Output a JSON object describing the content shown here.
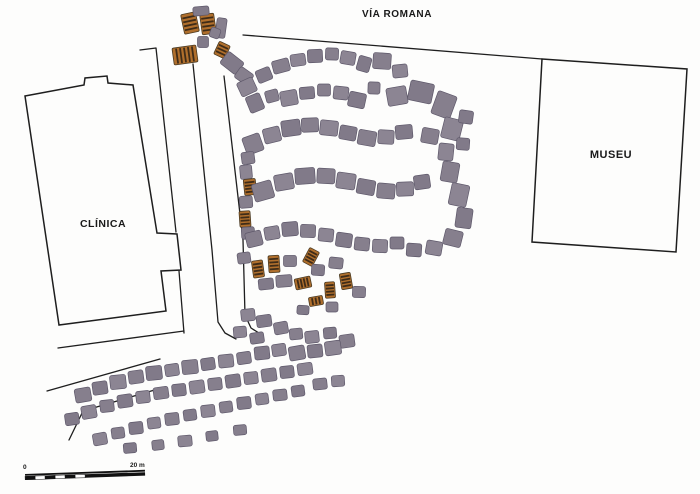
{
  "labels": {
    "via_romana": "VÍA ROMANA",
    "clinica": "CLÍNICA",
    "museu": "MUSEU",
    "scale_zero": "0",
    "scale_end": "20 m"
  },
  "colors": {
    "line": "#1e1e1e",
    "building_fill": "#fdfdfc",
    "ruin_fills": [
      "#867f8d",
      "#8c8593",
      "#817a89"
    ],
    "ruin_stroke": "#5e586a",
    "excavation_fill": "#b06f2c",
    "excavation_stripe": "#3f2c18",
    "excavation_stroke": "#4a3a22"
  },
  "site_plan": {
    "canvas": {
      "width": 700,
      "height": 494
    },
    "buildings": [
      {
        "name": "clinica-building-outline",
        "points": [
          [
            25,
            96
          ],
          [
            84,
            85
          ],
          [
            85,
            78
          ],
          [
            107,
            76
          ],
          [
            108,
            83
          ],
          [
            133,
            85
          ],
          [
            157,
            233
          ],
          [
            177,
            234
          ],
          [
            181,
            270
          ],
          [
            161,
            271
          ],
          [
            166,
            311
          ],
          [
            59,
            325
          ]
        ]
      },
      {
        "name": "museu-building-outline",
        "points": [
          [
            542,
            59
          ],
          [
            687,
            69
          ],
          [
            676,
            252
          ],
          [
            532,
            242
          ]
        ]
      }
    ],
    "lines": [
      {
        "name": "via-romana-road-line",
        "points": [
          [
            243,
            35
          ],
          [
            542,
            59
          ]
        ]
      },
      {
        "name": "clinica-fence-north",
        "points": [
          [
            140,
            50
          ],
          [
            156,
            48
          ],
          [
            176,
            232
          ]
        ]
      },
      {
        "name": "clinica-fence-south",
        "points": [
          [
            179,
            271
          ],
          [
            184,
            333
          ]
        ]
      },
      {
        "name": "road-south-of-clinica",
        "points": [
          [
            58,
            348
          ],
          [
            184,
            331
          ]
        ]
      },
      {
        "name": "boundary-line-mid",
        "points": [
          [
            47,
            391
          ],
          [
            160,
            359
          ]
        ]
      },
      {
        "name": "boundary-line-low",
        "points": [
          [
            69,
            440
          ],
          [
            83,
            411
          ],
          [
            158,
            389
          ]
        ]
      },
      {
        "name": "street-west-edge",
        "points": [
          [
            193,
            64
          ],
          [
            212,
            250
          ],
          [
            218,
            322
          ],
          [
            225,
            333
          ],
          [
            236,
            339
          ]
        ]
      },
      {
        "name": "street-east-edge",
        "points": [
          [
            224,
            76
          ],
          [
            243,
            240
          ],
          [
            245,
            315
          ],
          [
            251,
            328
          ],
          [
            262,
            335
          ]
        ]
      }
    ],
    "blocks_format": "[cx,cy,w,h,rot_deg,type] type 0=stone-ruin 1=striped-excavation",
    "blocks": [
      [
        190,
        23,
        15,
        20,
        -12,
        1
      ],
      [
        208,
        24,
        14,
        20,
        -8,
        1
      ],
      [
        201,
        11,
        16,
        9,
        -5,
        0
      ],
      [
        221,
        28,
        10,
        20,
        8,
        0
      ],
      [
        185,
        55,
        24,
        17,
        -8,
        1
      ],
      [
        203,
        42,
        11,
        11,
        0,
        0
      ],
      [
        215,
        33,
        10,
        10,
        20,
        0
      ],
      [
        222,
        50,
        12,
        14,
        25,
        1
      ],
      [
        232,
        63,
        20,
        15,
        38,
        0
      ],
      [
        244,
        76,
        16,
        13,
        35,
        0
      ],
      [
        247,
        87,
        17,
        15,
        -25,
        0
      ],
      [
        264,
        75,
        15,
        13,
        -22,
        0
      ],
      [
        281,
        66,
        17,
        13,
        -15,
        0
      ],
      [
        298,
        60,
        15,
        12,
        -8,
        0
      ],
      [
        315,
        56,
        15,
        13,
        -3,
        0
      ],
      [
        332,
        54,
        13,
        12,
        2,
        0
      ],
      [
        348,
        58,
        15,
        13,
        10,
        0
      ],
      [
        364,
        64,
        13,
        15,
        16,
        0
      ],
      [
        382,
        61,
        18,
        16,
        4,
        0
      ],
      [
        400,
        71,
        15,
        13,
        -6,
        0
      ],
      [
        255,
        103,
        15,
        17,
        -22,
        0
      ],
      [
        272,
        96,
        13,
        12,
        -15,
        0
      ],
      [
        289,
        98,
        17,
        15,
        -10,
        0
      ],
      [
        307,
        93,
        15,
        12,
        -5,
        0
      ],
      [
        324,
        90,
        13,
        12,
        0,
        0
      ],
      [
        341,
        93,
        15,
        13,
        6,
        0
      ],
      [
        357,
        100,
        17,
        15,
        12,
        0
      ],
      [
        374,
        88,
        12,
        12,
        2,
        0
      ],
      [
        397,
        96,
        20,
        18,
        -10,
        0
      ],
      [
        421,
        92,
        24,
        20,
        12,
        0
      ],
      [
        444,
        105,
        20,
        24,
        20,
        0
      ],
      [
        452,
        129,
        19,
        21,
        14,
        0
      ],
      [
        466,
        117,
        14,
        13,
        8,
        0
      ],
      [
        430,
        136,
        17,
        15,
        10,
        0
      ],
      [
        446,
        152,
        15,
        17,
        6,
        0
      ],
      [
        463,
        144,
        13,
        12,
        4,
        0
      ],
      [
        253,
        144,
        18,
        18,
        -20,
        0
      ],
      [
        272,
        135,
        17,
        15,
        -14,
        0
      ],
      [
        291,
        128,
        19,
        16,
        -8,
        0
      ],
      [
        310,
        125,
        17,
        14,
        -2,
        0
      ],
      [
        329,
        128,
        18,
        15,
        6,
        0
      ],
      [
        348,
        133,
        17,
        14,
        10,
        0
      ],
      [
        367,
        138,
        18,
        15,
        10,
        0
      ],
      [
        386,
        137,
        16,
        14,
        3,
        0
      ],
      [
        404,
        132,
        17,
        14,
        -5,
        0
      ],
      [
        248,
        158,
        13,
        12,
        -8,
        0
      ],
      [
        246,
        172,
        12,
        14,
        -5,
        0
      ],
      [
        250,
        187,
        12,
        16,
        -6,
        1
      ],
      [
        246,
        202,
        13,
        12,
        -4,
        0
      ],
      [
        245,
        219,
        11,
        16,
        -4,
        1
      ],
      [
        248,
        233,
        13,
        12,
        -3,
        0
      ],
      [
        263,
        191,
        20,
        18,
        -16,
        0
      ],
      [
        284,
        182,
        19,
        16,
        -10,
        0
      ],
      [
        305,
        176,
        20,
        16,
        -4,
        0
      ],
      [
        326,
        176,
        18,
        15,
        3,
        0
      ],
      [
        346,
        181,
        19,
        16,
        8,
        0
      ],
      [
        366,
        187,
        18,
        15,
        10,
        0
      ],
      [
        386,
        191,
        18,
        15,
        5,
        0
      ],
      [
        405,
        189,
        17,
        14,
        -2,
        0
      ],
      [
        422,
        182,
        16,
        14,
        -8,
        0
      ],
      [
        450,
        172,
        17,
        20,
        10,
        0
      ],
      [
        459,
        195,
        18,
        22,
        12,
        0
      ],
      [
        464,
        218,
        16,
        20,
        8,
        0
      ],
      [
        453,
        238,
        18,
        16,
        14,
        0
      ],
      [
        434,
        248,
        16,
        14,
        10,
        0
      ],
      [
        414,
        250,
        15,
        13,
        4,
        0
      ],
      [
        254,
        239,
        16,
        15,
        -14,
        0
      ],
      [
        272,
        233,
        15,
        13,
        -10,
        0
      ],
      [
        290,
        229,
        16,
        14,
        -5,
        0
      ],
      [
        308,
        231,
        15,
        13,
        2,
        0
      ],
      [
        326,
        235,
        15,
        13,
        6,
        0
      ],
      [
        344,
        240,
        16,
        14,
        8,
        0
      ],
      [
        362,
        244,
        15,
        13,
        6,
        0
      ],
      [
        380,
        246,
        15,
        13,
        3,
        0
      ],
      [
        397,
        243,
        14,
        12,
        0,
        0
      ],
      [
        244,
        258,
        13,
        11,
        -8,
        0
      ],
      [
        258,
        269,
        11,
        17,
        -8,
        1
      ],
      [
        274,
        264,
        11,
        17,
        -4,
        1
      ],
      [
        290,
        261,
        13,
        11,
        0,
        0
      ],
      [
        311,
        257,
        11,
        16,
        28,
        1
      ],
      [
        266,
        284,
        15,
        11,
        -6,
        0
      ],
      [
        284,
        281,
        16,
        12,
        -4,
        0
      ],
      [
        303,
        283,
        11,
        16,
        78,
        1
      ],
      [
        318,
        270,
        13,
        11,
        4,
        0
      ],
      [
        336,
        263,
        14,
        11,
        6,
        0
      ],
      [
        330,
        290,
        10,
        16,
        -4,
        1
      ],
      [
        346,
        281,
        11,
        16,
        -10,
        1
      ],
      [
        359,
        292,
        13,
        11,
        2,
        0
      ],
      [
        316,
        301,
        9,
        14,
        80,
        1
      ],
      [
        303,
        310,
        12,
        9,
        4,
        0
      ],
      [
        332,
        307,
        12,
        10,
        0,
        0
      ],
      [
        248,
        315,
        14,
        12,
        -6,
        0
      ],
      [
        264,
        321,
        15,
        12,
        -8,
        0
      ],
      [
        281,
        328,
        14,
        12,
        -10,
        0
      ],
      [
        240,
        332,
        13,
        11,
        -5,
        0
      ],
      [
        257,
        338,
        14,
        11,
        -8,
        0
      ],
      [
        296,
        334,
        13,
        11,
        -6,
        0
      ],
      [
        312,
        337,
        14,
        12,
        -6,
        0
      ],
      [
        330,
        333,
        13,
        11,
        -5,
        0
      ],
      [
        347,
        341,
        15,
        13,
        -8,
        0
      ],
      [
        333,
        348,
        16,
        14,
        -8,
        0
      ],
      [
        315,
        351,
        15,
        13,
        -6,
        0
      ],
      [
        297,
        353,
        16,
        14,
        -10,
        0
      ],
      [
        279,
        350,
        14,
        12,
        -8,
        0
      ],
      [
        262,
        353,
        15,
        13,
        -6,
        0
      ],
      [
        244,
        358,
        14,
        12,
        -8,
        0
      ],
      [
        226,
        361,
        15,
        13,
        -6,
        0
      ],
      [
        208,
        364,
        14,
        12,
        -8,
        0
      ],
      [
        190,
        367,
        16,
        14,
        -6,
        0
      ],
      [
        172,
        370,
        14,
        12,
        -8,
        0
      ],
      [
        154,
        373,
        16,
        14,
        -6,
        0
      ],
      [
        136,
        377,
        15,
        13,
        -8,
        0
      ],
      [
        118,
        382,
        16,
        14,
        -6,
        0
      ],
      [
        100,
        388,
        15,
        13,
        -8,
        0
      ],
      [
        83,
        395,
        16,
        14,
        -10,
        0
      ],
      [
        305,
        369,
        15,
        12,
        -8,
        0
      ],
      [
        287,
        372,
        14,
        12,
        -6,
        0
      ],
      [
        269,
        375,
        15,
        13,
        -8,
        0
      ],
      [
        251,
        378,
        14,
        12,
        -6,
        0
      ],
      [
        233,
        381,
        15,
        13,
        -8,
        0
      ],
      [
        215,
        384,
        14,
        12,
        -6,
        0
      ],
      [
        197,
        387,
        15,
        13,
        -8,
        0
      ],
      [
        179,
        390,
        14,
        12,
        -6,
        0
      ],
      [
        161,
        393,
        15,
        12,
        -8,
        0
      ],
      [
        143,
        397,
        14,
        12,
        -6,
        0
      ],
      [
        125,
        401,
        15,
        13,
        -8,
        0
      ],
      [
        107,
        406,
        14,
        12,
        -6,
        0
      ],
      [
        89,
        412,
        15,
        13,
        -10,
        0
      ],
      [
        72,
        419,
        14,
        12,
        -8,
        0
      ],
      [
        320,
        384,
        14,
        11,
        -6,
        0
      ],
      [
        338,
        381,
        13,
        11,
        -4,
        0
      ],
      [
        298,
        391,
        13,
        11,
        -8,
        0
      ],
      [
        280,
        395,
        14,
        11,
        -6,
        0
      ],
      [
        262,
        399,
        13,
        11,
        -8,
        0
      ],
      [
        244,
        403,
        14,
        12,
        -6,
        0
      ],
      [
        226,
        407,
        13,
        11,
        -8,
        0
      ],
      [
        208,
        411,
        14,
        12,
        -6,
        0
      ],
      [
        190,
        415,
        13,
        11,
        -8,
        0
      ],
      [
        172,
        419,
        14,
        12,
        -6,
        0
      ],
      [
        154,
        423,
        13,
        11,
        -8,
        0
      ],
      [
        136,
        428,
        14,
        12,
        -6,
        0
      ],
      [
        118,
        433,
        13,
        11,
        -8,
        0
      ],
      [
        100,
        439,
        14,
        12,
        -10,
        0
      ],
      [
        130,
        448,
        13,
        10,
        -5,
        0
      ],
      [
        158,
        445,
        12,
        10,
        -6,
        0
      ],
      [
        185,
        441,
        14,
        11,
        -5,
        0
      ],
      [
        212,
        436,
        12,
        10,
        -6,
        0
      ],
      [
        240,
        430,
        13,
        10,
        -5,
        0
      ]
    ],
    "scale_bar": {
      "x": 25,
      "y": 474,
      "length": 120,
      "rotation": -2,
      "segment_length": 10,
      "checker_segments": 6
    }
  }
}
